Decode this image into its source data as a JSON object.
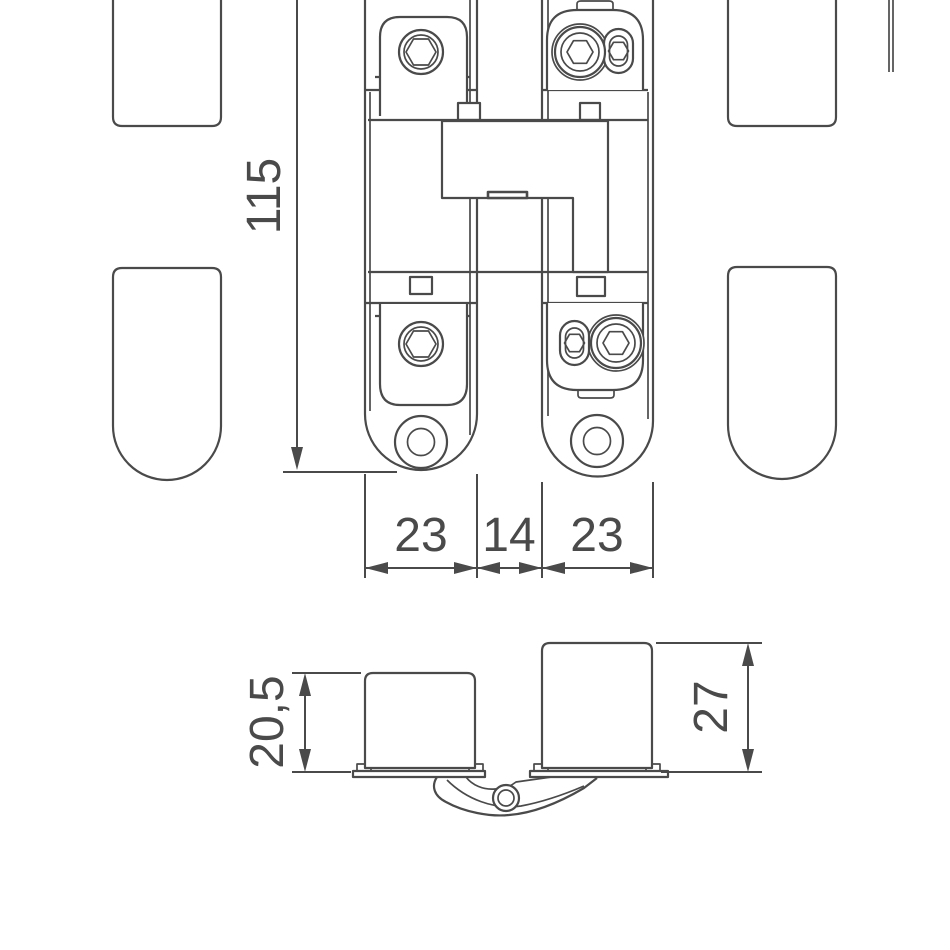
{
  "colors": {
    "line": "#4a4a4a",
    "background": "#ffffff"
  },
  "front_view": {
    "height_dim": "115",
    "width_dims": [
      "23",
      "14",
      "23"
    ]
  },
  "section_view": {
    "left_depth_dim": "20,5",
    "right_depth_dim": "27"
  }
}
